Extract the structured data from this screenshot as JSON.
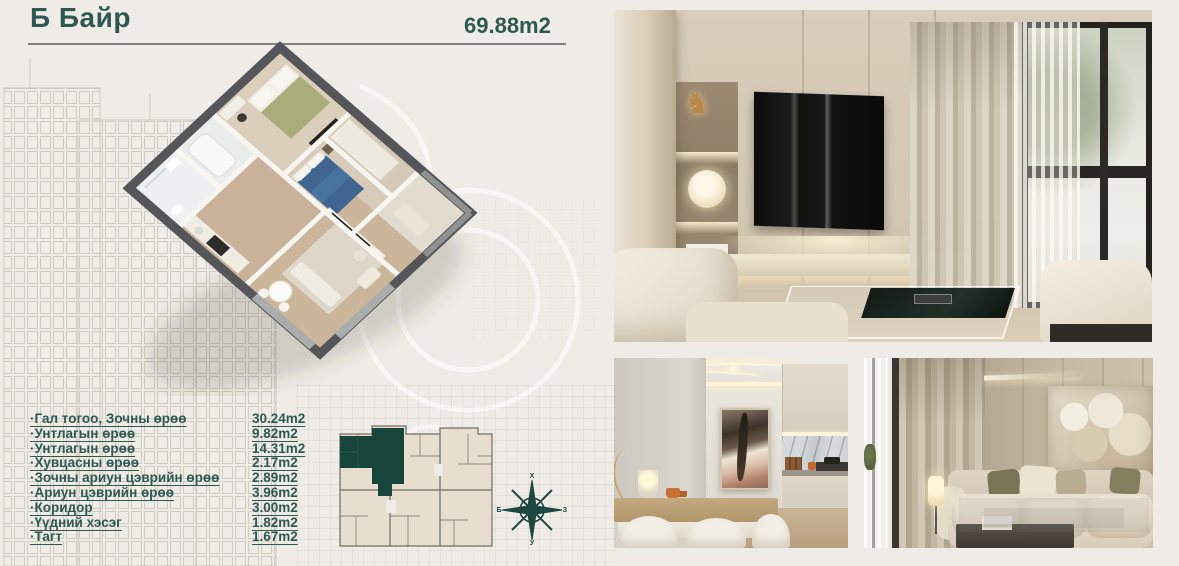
{
  "header": {
    "title": "Б Байр",
    "area": "69.88m2"
  },
  "rooms": {
    "items": [
      {
        "label": "·Гал тогоо, Зочны өрөө",
        "area": "30.24m2"
      },
      {
        "label": "·Унтлагын өрөө",
        "area": "9.82m2"
      },
      {
        "label": "·Унтлагын өрөө",
        "area": "14.31m2"
      },
      {
        "label": "·Хувцасны өрөө",
        "area": "2.17m2"
      },
      {
        "label": "·Зочны ариун цэврийн өрөө",
        "area": "2.89m2"
      },
      {
        "label": "·Ариун цэврийн өрөө",
        "area": "3.96m2"
      },
      {
        "label": "·Коридор",
        "area": "3.00m2"
      },
      {
        "label": "·Үүдний хэсэг",
        "area": "1.82m2"
      },
      {
        "label": "·Тагт",
        "area": "1.67m2"
      }
    ]
  },
  "compass": {
    "north": "Х",
    "east": "З",
    "south": "У",
    "west": "Б"
  },
  "icons": {
    "horse_sculpture": "♞"
  },
  "colors": {
    "accent_teal": "#2e5850",
    "highlight_unit": "#18453c",
    "keyplan_fill": "#e8decd",
    "plan_wall": "#55565a",
    "background": "#efece7"
  }
}
